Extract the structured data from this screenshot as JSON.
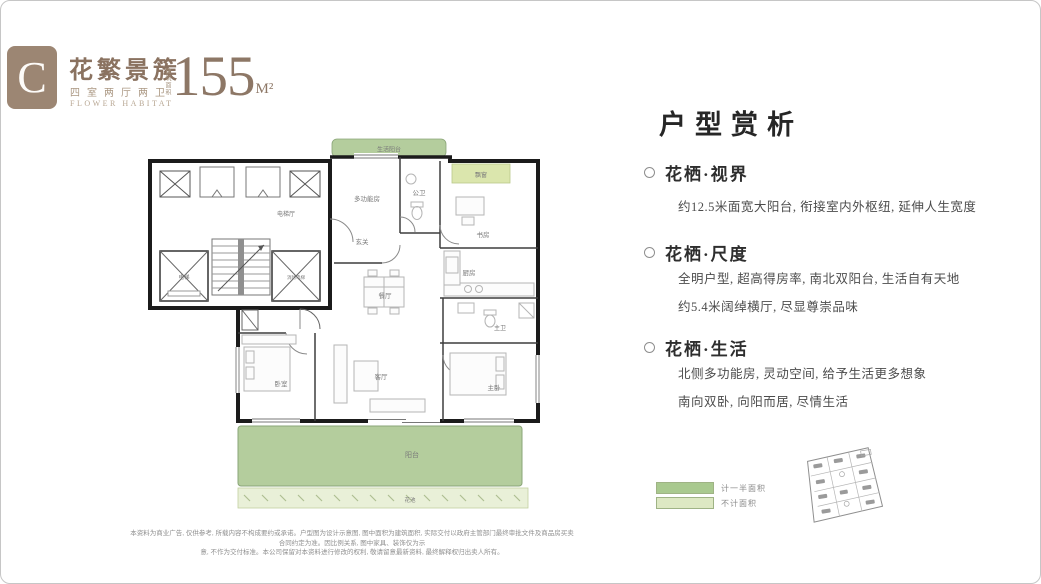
{
  "header": {
    "logo_letter": "C",
    "title": "花繁景簇",
    "subtitle": "四室两厅两卫",
    "subtitle_en": "FLOWER HABITAT",
    "area_label": "建筑面积",
    "area_value": "155",
    "area_unit": "M²"
  },
  "floorplan": {
    "rooms": {
      "service_balcony": "生活阳台",
      "bay_window": "飘窗",
      "multi_function": "多功能房",
      "guest_bath": "公卫",
      "study": "书房",
      "foyer": "玄关",
      "kitchen": "厨房",
      "dining": "餐厅",
      "elevator_hall": "电梯厅",
      "elevator": "电梯",
      "fire_elevator": "消防电梯",
      "bedroom": "卧室",
      "living": "客厅",
      "master_bedroom": "主卧",
      "master_bath": "主卫",
      "balcony": "阳台",
      "flower_bed": "花池"
    },
    "colors": {
      "balcony_green": "#b4cd9d",
      "bay_window_green": "#dbe6ad",
      "flower_bed_green": "#e9f0d8",
      "wall_black": "#1b1b1b",
      "brand_brown": "#9c8673"
    }
  },
  "analysis": {
    "title": "户型赏析",
    "sections": [
      {
        "heading": "花栖·视界",
        "lines": [
          "约12.5米面宽大阳台, 衔接室内外枢纽, 延伸人生宽度"
        ]
      },
      {
        "heading": "花栖·尺度",
        "lines": [
          "全明户型, 超高得房率, 南北双阳台, 生活自有天地",
          "约5.4米阔绰横厅, 尽显尊崇品味"
        ]
      },
      {
        "heading": "花栖·生活",
        "lines": [
          "北侧多功能房, 灵动空间, 给予生活更多想象",
          "南向双卧, 向阳而居, 尽情生活"
        ]
      }
    ]
  },
  "legend": {
    "items": [
      {
        "label": "计一半面积",
        "color": "#a9c98f"
      },
      {
        "label": "不计面积",
        "color": "#dde8c3"
      }
    ]
  },
  "footnote": {
    "line1": "本资料为商业广告, 仅供参考, 所载内容不构成要约或承诺。户型图为设计示意图, 图中面积为建筑面积, 实际交付以政府主管部门最终审批文件及商品房买卖合同约定为准。因比例关系, 图中家具、装饰仅为示",
    "line2": "意, 不作为交付标准。本公司保留对本资料进行修改的权利, 敬请留意最新资料, 最终解释权归出卖人所有。"
  }
}
